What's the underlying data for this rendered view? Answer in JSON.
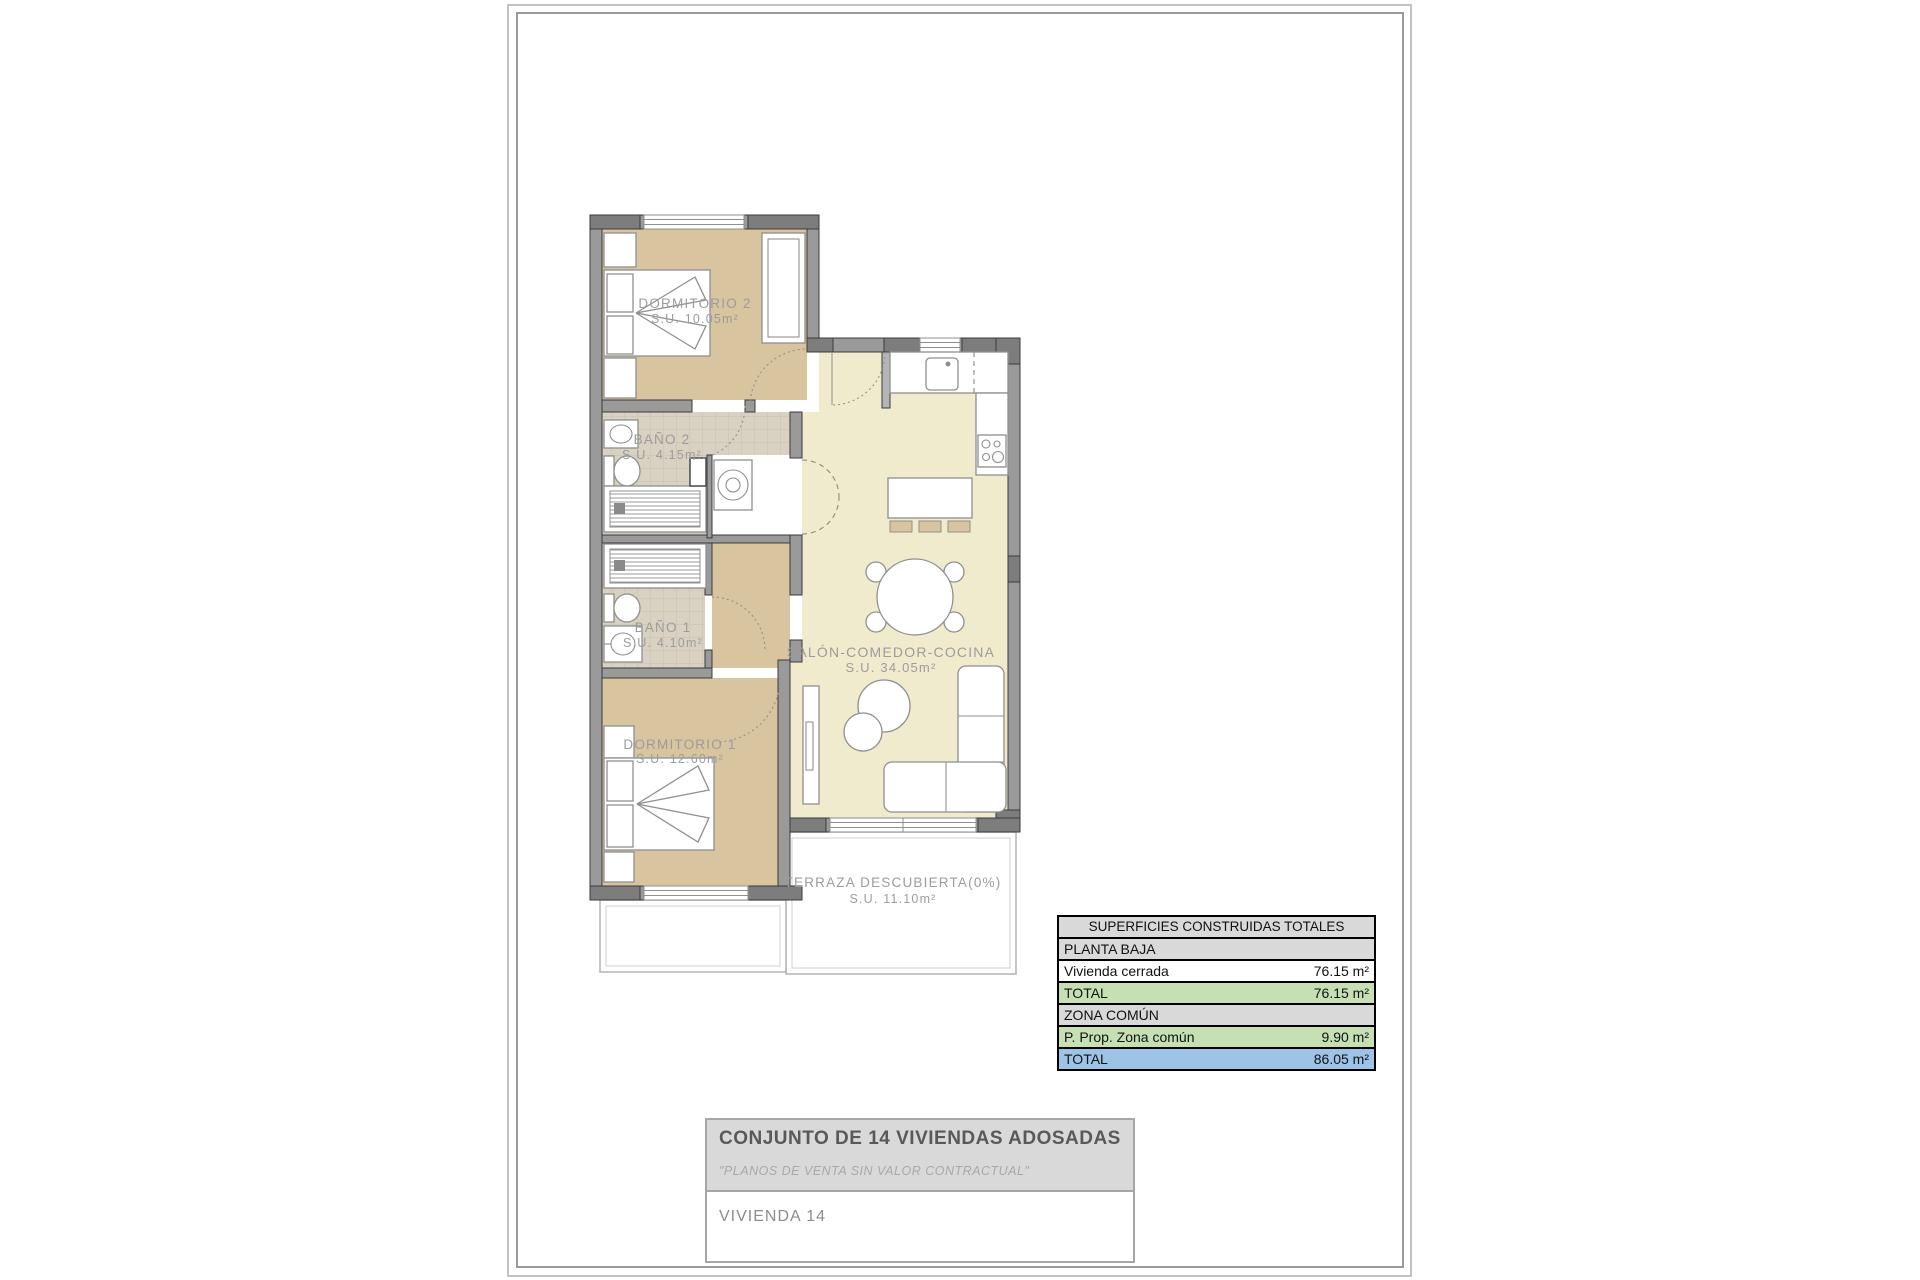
{
  "plan": {
    "rooms": [
      {
        "id": "dormitorio2",
        "label": "DORMITORIO 2",
        "area": "S.U. 10.05m²"
      },
      {
        "id": "bano2",
        "label": "BAÑO 2",
        "area": "S.U. 4.15m²"
      },
      {
        "id": "bano1",
        "label": "BAÑO 1",
        "area": "S.U. 4.10m²"
      },
      {
        "id": "dormitorio1",
        "label": "DORMITORIO 1",
        "area": "S.U. 12.60m²"
      },
      {
        "id": "salon",
        "label": "SALÓN-COMEDOR-COCINA",
        "area": "S.U. 34.05m²"
      },
      {
        "id": "terraza",
        "label": "TERRAZA DESCUBIERTA(0%)",
        "area": "S.U. 11.10m²"
      }
    ],
    "colors": {
      "bedroom_floor": "#d8c49e",
      "living_floor": "#f0ebcd",
      "bath_tile": "#d9d2c3",
      "wall": "#9a9a9a"
    }
  },
  "surface_table": {
    "title": "SUPERFICIES CONSTRUIDAS TOTALES",
    "rows": [
      {
        "label": "PLANTA BAJA",
        "value": "",
        "type": "section"
      },
      {
        "label": "Vivienda cerrada",
        "value": "76.15 m²",
        "type": "plain"
      },
      {
        "label": "TOTAL",
        "value": "76.15 m²",
        "type": "green"
      },
      {
        "label": "ZONA COMÚN",
        "value": "",
        "type": "section"
      },
      {
        "label": "P. Prop. Zona común",
        "value": "9.90 m²",
        "type": "green"
      },
      {
        "label": "TOTAL",
        "value": "86.05 m²",
        "type": "blue"
      }
    ],
    "colors": {
      "section": "#d9d9d9",
      "green": "#c6e0b4",
      "blue": "#9dc3e6"
    }
  },
  "title_block": {
    "project": "CONJUNTO DE 14 VIVIENDAS ADOSADAS",
    "disclaimer": "\"PLANOS DE VENTA SIN VALOR CONTRACTUAL\"",
    "unit": "VIVIENDA 14"
  }
}
